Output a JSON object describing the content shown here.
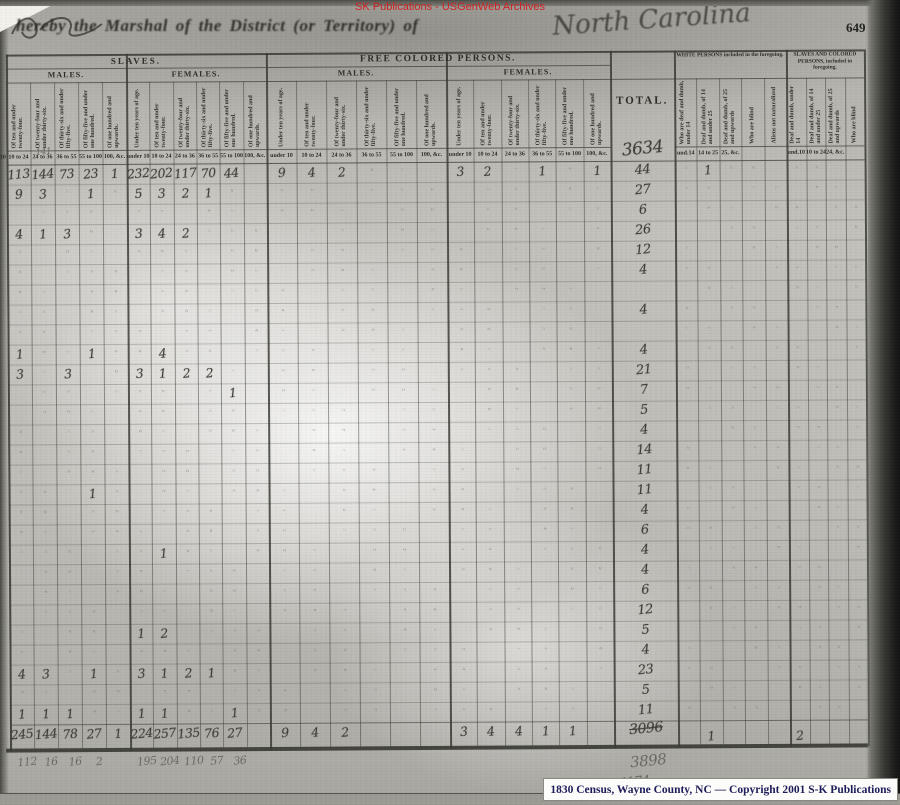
{
  "overlay": {
    "watermark_top": "SK Publications - USGenWeb Archives",
    "bottom_credit": "1830 Census, Wayne County, NC — Copyright 2001 S-K Publications"
  },
  "page": {
    "number": "649",
    "printed_header": "hereby the Marshal of the             District (or Territory) of",
    "handwritten_state": "North Carolina",
    "header": {
      "slaves_title": "SLAVES.",
      "free_colored_title": "FREE COLORED PERSONS.",
      "males": "MALES.",
      "females": "FEMALES.",
      "total_label": "TOTAL.",
      "white_included_title": "WHITE PERSONS included in the foregoing.",
      "slaves_colored_included_title": "SLAVES AND COLORED PERSONS, included in foregoing.",
      "age_column_labels": [
        "Under ten years of age.",
        "Of ten and under twenty-four.",
        "Of twenty-four and under thirty-six.",
        "Of thirty-six and under fifty-five.",
        "Of fifty-five and under one hundred.",
        "Of one hundred and upwards."
      ],
      "age_ticks": [
        "under 10",
        "10 to 24",
        "24 to 36",
        "36 to 55",
        "55 to 100",
        "100, &c."
      ],
      "white_column_labels": [
        "Who are deaf and dumb, under 14",
        "Deaf and dumb, of 14 and under 25",
        "Deaf and dumb, of 25 and upwards",
        "Who are blind",
        "Aliens not naturalized"
      ],
      "white_ticks": [
        "und.14",
        "14 to 25",
        "25, &c.",
        "",
        ""
      ],
      "sc_column_labels": [
        "Deaf and dumb, under 14",
        "Deaf and dumb, of 14 and under 25",
        "Deaf and dumb, of 25 and upwards",
        "Who are blind"
      ],
      "sc_ticks": [
        "und.10",
        "10 to 24",
        "24, &c.",
        ""
      ]
    },
    "grand_total": "3634",
    "pencil_note": "141",
    "rows": [
      {
        "c": {
          "1": "113",
          "2": "144",
          "3": "73",
          "4": "23",
          "5": "1",
          "6": "232",
          "7": "202",
          "8": "117",
          "9": "70",
          "10": "44",
          "12": "9",
          "13": "4",
          "14": "2",
          "18": "3",
          "19": "2",
          "21": "1",
          "23": "1"
        },
        "t": "44",
        "r": {
          "1": "1"
        },
        "d": true
      },
      {
        "c": {
          "1": "9",
          "2": "3",
          "4": "1",
          "6": "5",
          "7": "3",
          "8": "2",
          "9": "1"
        },
        "t": "27",
        "r": {},
        "d": true
      },
      {
        "c": {},
        "t": "6",
        "r": {},
        "d": true
      },
      {
        "c": {
          "1": "4",
          "2": "1",
          "3": "3",
          "6": "3",
          "7": "4",
          "8": "2"
        },
        "t": "26",
        "r": {},
        "d": true
      },
      {
        "c": {},
        "t": "12",
        "r": {},
        "d": true
      },
      {
        "c": {},
        "t": "4",
        "r": {},
        "d": true
      },
      {
        "c": {},
        "t": "",
        "r": {},
        "d": true
      },
      {
        "c": {},
        "t": "4",
        "r": {},
        "d": true
      },
      {
        "c": {},
        "t": "",
        "r": {},
        "d": true
      },
      {
        "c": {
          "1": "1",
          "4": "1",
          "7": "4"
        },
        "t": "4",
        "r": {},
        "d": true
      },
      {
        "c": {
          "1": "3",
          "3": "3",
          "6": "3",
          "7": "1",
          "8": "2",
          "9": "2"
        },
        "t": "21",
        "r": {},
        "d": true
      },
      {
        "c": {
          "10": "1"
        },
        "t": "7",
        "r": {},
        "d": true
      },
      {
        "c": {},
        "t": "5",
        "r": {},
        "d": true
      },
      {
        "c": {},
        "t": "4",
        "r": {},
        "d": true
      },
      {
        "c": {},
        "t": "14",
        "r": {},
        "d": true
      },
      {
        "c": {},
        "t": "11",
        "r": {},
        "d": true
      },
      {
        "c": {
          "4": "1"
        },
        "t": "11",
        "r": {},
        "d": true
      },
      {
        "c": {},
        "t": "4",
        "r": {},
        "d": true
      },
      {
        "c": {},
        "t": "6",
        "r": {},
        "d": true
      },
      {
        "c": {
          "7": "1"
        },
        "t": "4",
        "r": {},
        "d": true
      },
      {
        "c": {},
        "t": "4",
        "r": {},
        "d": true
      },
      {
        "c": {},
        "t": "6",
        "r": {},
        "d": true
      },
      {
        "c": {},
        "t": "12",
        "r": {},
        "d": true
      },
      {
        "c": {
          "6": "1",
          "7": "2"
        },
        "t": "5",
        "r": {},
        "d": true
      },
      {
        "c": {},
        "t": "4",
        "r": {},
        "d": true
      },
      {
        "c": {
          "1": "4",
          "2": "3",
          "4": "1",
          "6": "3",
          "7": "1",
          "8": "2",
          "9": "1"
        },
        "t": "23",
        "r": {},
        "d": true
      },
      {
        "c": {},
        "t": "5",
        "r": {},
        "d": true
      },
      {
        "c": {
          "1": "1",
          "2": "1",
          "3": "1",
          "6": "1",
          "7": "1",
          "10": "1"
        },
        "t": "11",
        "r": {},
        "d": true
      }
    ],
    "totals_row": {
      "c": {
        "1": "245",
        "2": "144",
        "3": "78",
        "4": "27",
        "5": "1",
        "6": "224",
        "7": "257",
        "8": "135",
        "9": "76",
        "10": "27",
        "12": "9",
        "13": "4",
        "14": "2",
        "18": "3",
        "19": "4",
        "20": "4",
        "21": "1",
        "22": "1"
      },
      "total_struck": "3096",
      "r": {
        "1": "1",
        "5": "2"
      }
    },
    "pencil_totals": {
      "c": {
        "1": "112",
        "2": "16",
        "3": "16",
        "4": "2",
        "6": "195",
        "7": "204",
        "8": "110",
        "9": "57",
        "10": "36"
      },
      "total": "3898"
    },
    "final_total": "4174"
  }
}
